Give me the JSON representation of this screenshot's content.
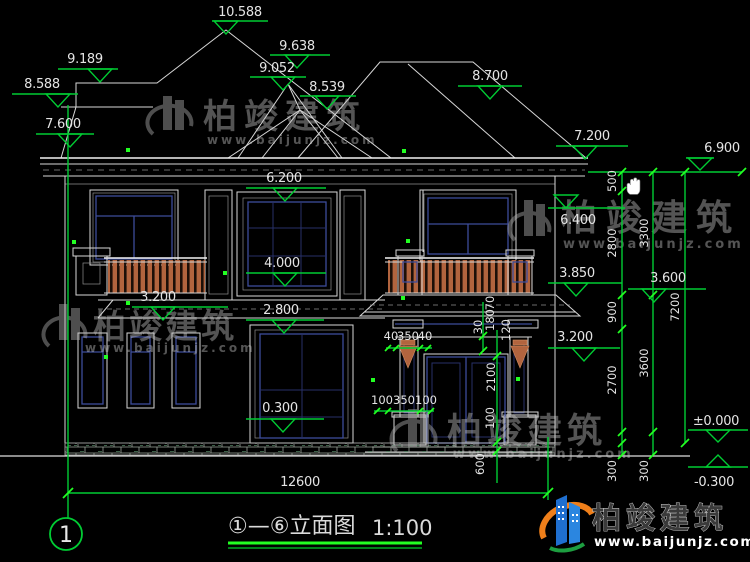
{
  "colors": {
    "background": "#000000",
    "cad_line": "#d7d7d7",
    "dimension_green": "#00cc33",
    "grip_green": "#22ff22",
    "window_navy": "#3c4c9a",
    "railing_orange": "#b2643e",
    "roof_tile_gray": "#8f9898",
    "logo_blue": "#1f6fd0",
    "logo_orange": "#ef7f1a"
  },
  "elevations": {
    "ridge": "10.588",
    "rear_ridge": "9.638",
    "hip_a": "9.052",
    "hip_b": "8.539",
    "parapet": "9.189",
    "parapet_lower": "8.588",
    "eave_left": "7.600",
    "rear_eave_right": "8.700",
    "eave_right": "7.200",
    "eave_outer_right": "6.900",
    "window2f_top": "6.200",
    "window2f_sill": "4.000",
    "floor2_level": "2.800",
    "floor1_sill": "0.300",
    "balcony_left": "3.200",
    "window2f_right_top": "6.400",
    "balcony_right": "3.850",
    "canopy_right": "3.200",
    "canopy_outer": "3.600",
    "ground_zero": "±0.000",
    "ground_minus": "-0.300"
  },
  "dim_chains": {
    "overall_width": "12600",
    "a": [
      "500",
      "2800",
      "900",
      "2700",
      "300"
    ],
    "b": [
      "3300",
      "3600",
      "300"
    ],
    "c": [
      "7200"
    ]
  },
  "detail_dims": {
    "capital": [
      "40",
      "350",
      "40"
    ],
    "pedestal": [
      "100",
      "350",
      "100"
    ],
    "beam": [
      "30",
      "180",
      "70",
      "120"
    ],
    "door_height": "2100",
    "threshold": "100",
    "step": "600"
  },
  "title_block": {
    "axis_bubble": "1",
    "title": "①—⑥立面图",
    "scale": "1:100"
  },
  "brand": {
    "name": "柏竣建筑",
    "url": "www.baijunjz.com"
  }
}
